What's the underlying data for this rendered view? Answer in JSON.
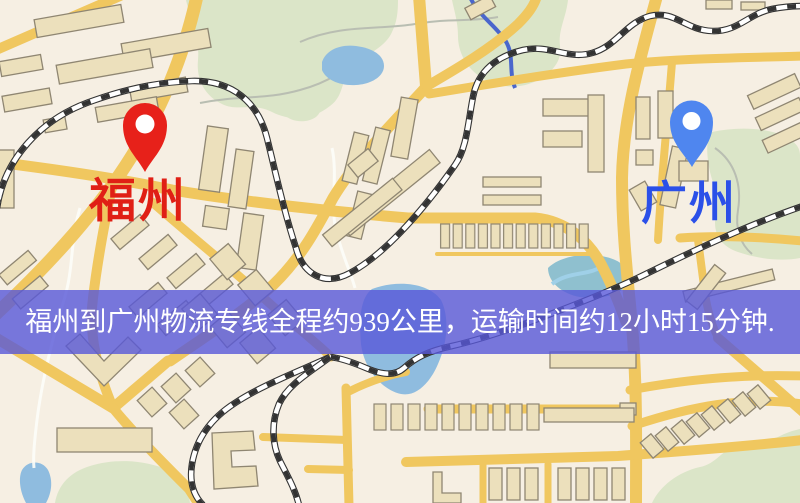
{
  "map": {
    "origin": {
      "label": "福州",
      "pin_icon": "red-location-pin",
      "pin_color": "#e7211a",
      "label_color": "#e01f15"
    },
    "destination": {
      "label": "广州",
      "pin_icon": "blue-location-pin",
      "pin_color": "#4f86ef",
      "label_color": "#2b50e8"
    },
    "banner": {
      "text": "福州到广州物流专线全程约939公里，运输时间约12小时15分钟.",
      "background": "rgba(88,88,216,0.8)",
      "text_color": "#ffffff"
    },
    "palette": {
      "map_base": "#f6efe3",
      "road": "#f0c75f",
      "water": "#8fbcdf",
      "green_area": "#dbe5c8",
      "building": "#ece0bc",
      "building_outline": "#8f8672",
      "railway": "#333333"
    }
  }
}
